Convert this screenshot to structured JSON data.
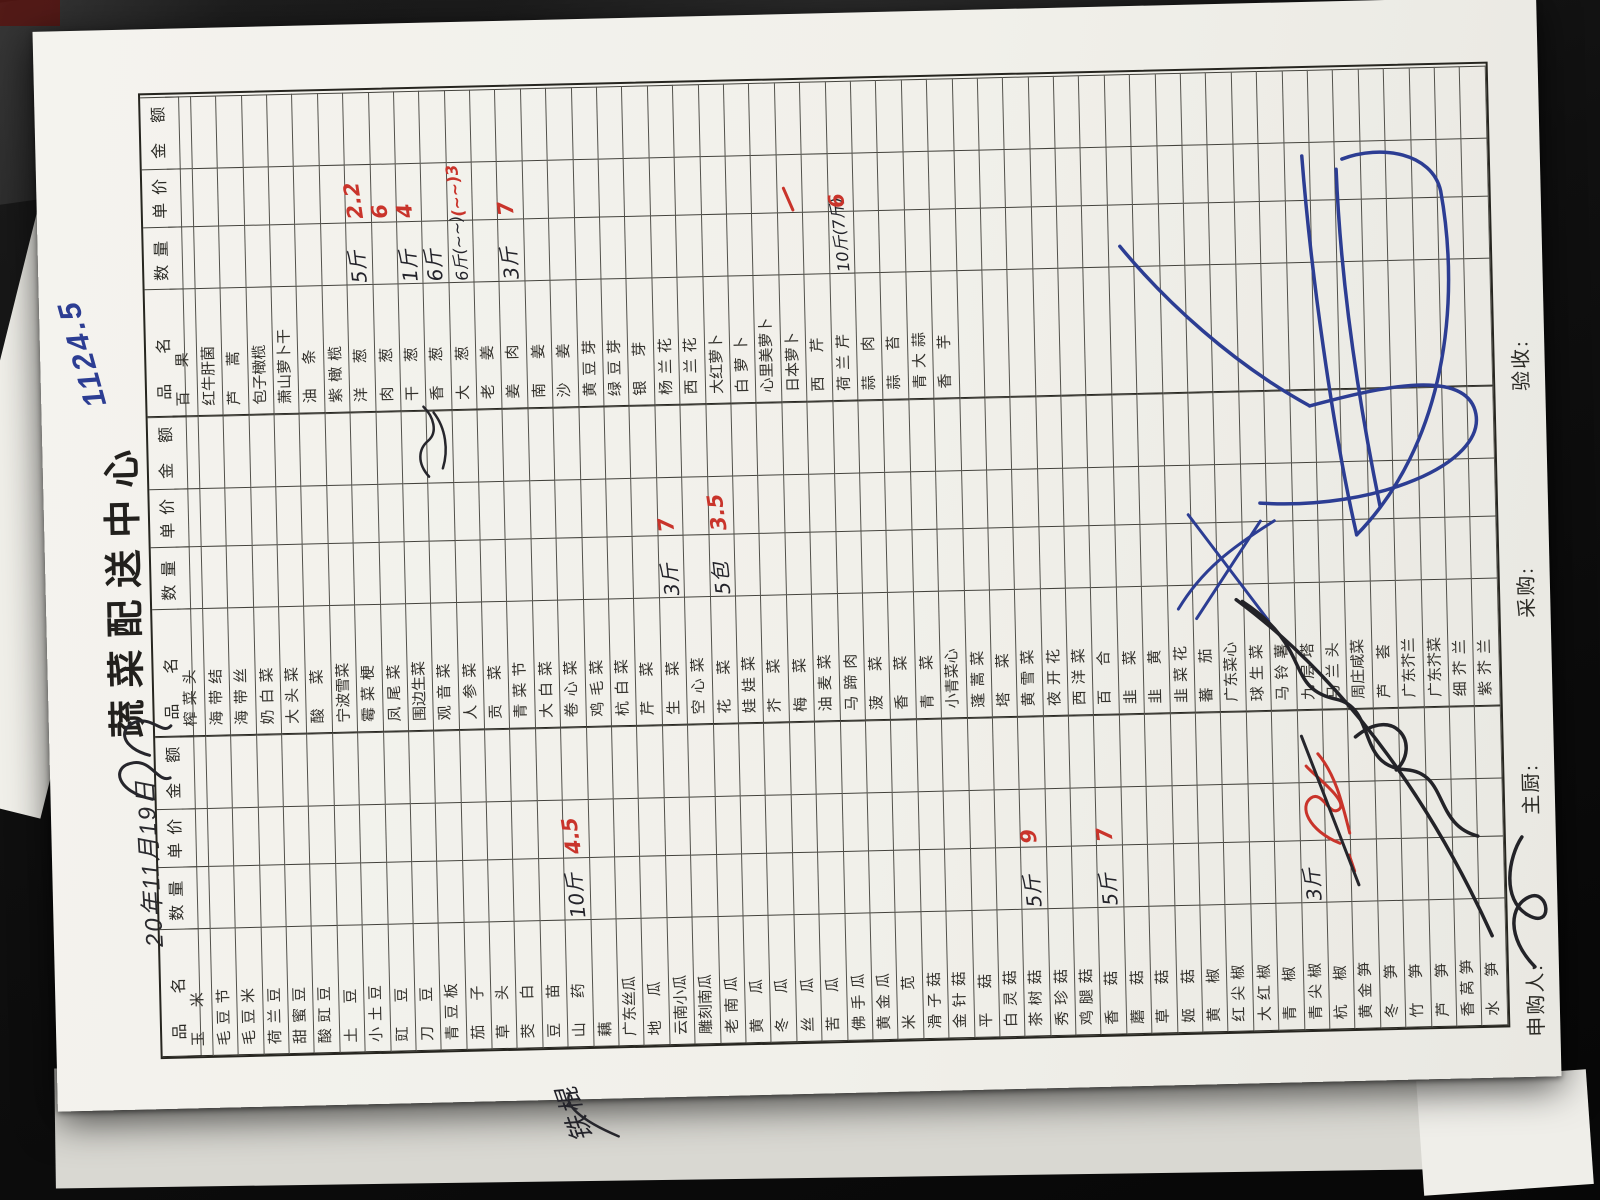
{
  "scene": {
    "background": "#0d0d0d",
    "paper_color": "#f2f1ec"
  },
  "ink": {
    "red": "#c9342b",
    "blue": "#2c3d93",
    "black": "#23232a"
  },
  "header": {
    "date_handwritten": "20年11月19日",
    "title": "蔬菜配送中心",
    "blue_total": "1124.5"
  },
  "table": {
    "column_headers": [
      "品名",
      "数量",
      "单价",
      "金额"
    ],
    "row_count": 52,
    "groups": [
      {
        "rows": [
          {
            "n": "玉米"
          },
          {
            "n": "毛豆节"
          },
          {
            "n": "毛豆米"
          },
          {
            "n": "荷兰豆"
          },
          {
            "n": "甜蜜豆"
          },
          {
            "n": "酸豇豆"
          },
          {
            "n": "土豆"
          },
          {
            "n": "小土豆"
          },
          {
            "n": "豇豆"
          },
          {
            "n": "刀豆"
          },
          {
            "n": "青豆板"
          },
          {
            "n": "茄子"
          },
          {
            "n": "草头"
          },
          {
            "n": "茭白"
          },
          {
            "n": "豆苗"
          },
          {
            "n": "山药",
            "q": "10斤",
            "p": "4.5",
            "note": "铁棍"
          },
          {
            "n": "藕"
          },
          {
            "n": "广东丝瓜"
          },
          {
            "n": "地瓜"
          },
          {
            "n": "云南小瓜"
          },
          {
            "n": "雕刻南瓜"
          },
          {
            "n": "老南瓜"
          },
          {
            "n": "黄瓜"
          },
          {
            "n": "冬瓜"
          },
          {
            "n": "丝瓜"
          },
          {
            "n": "苦瓜"
          },
          {
            "n": "佛手瓜"
          },
          {
            "n": "黄金瓜"
          },
          {
            "n": "米苋"
          },
          {
            "n": "滑子菇"
          },
          {
            "n": "金针菇"
          },
          {
            "n": "平菇"
          },
          {
            "n": "白灵菇"
          },
          {
            "n": "茶树菇",
            "q": "5斤",
            "p": "9"
          },
          {
            "n": "秀珍菇"
          },
          {
            "n": "鸡腿菇"
          },
          {
            "n": "香菇",
            "q": "5斤",
            "p": "7"
          },
          {
            "n": "蘑菇"
          },
          {
            "n": "草菇"
          },
          {
            "n": "姬菇"
          },
          {
            "n": "黄椒"
          },
          {
            "n": "红尖椒"
          },
          {
            "n": "大红椒"
          },
          {
            "n": "青椒"
          },
          {
            "n": "青尖椒",
            "q": "3斤"
          },
          {
            "n": "杭椒"
          },
          {
            "n": "黄金笋"
          },
          {
            "n": "冬笋"
          },
          {
            "n": "竹笋"
          },
          {
            "n": "芦笋"
          },
          {
            "n": "香莴笋"
          },
          {
            "n": "水笋"
          }
        ]
      },
      {
        "rows": [
          {
            "n": "榨菜头"
          },
          {
            "n": "海带结"
          },
          {
            "n": "海带丝"
          },
          {
            "n": "奶白菜"
          },
          {
            "n": "大头菜"
          },
          {
            "n": "酸菜"
          },
          {
            "n": "宁波雪菜"
          },
          {
            "n": "霉菜梗"
          },
          {
            "n": "凤尾菜"
          },
          {
            "n": "围边生菜"
          },
          {
            "n": "观音菜"
          },
          {
            "n": "人参菜"
          },
          {
            "n": "贡菜"
          },
          {
            "n": "青菜节"
          },
          {
            "n": "大白菜"
          },
          {
            "n": "卷心菜"
          },
          {
            "n": "鸡毛菜"
          },
          {
            "n": "杭白菜"
          },
          {
            "n": "芹菜"
          },
          {
            "n": "生菜",
            "q": "3斤",
            "p": "7"
          },
          {
            "n": "空心菜"
          },
          {
            "n": "花菜",
            "q": "5包",
            "p": "3.5"
          },
          {
            "n": "娃娃菜"
          },
          {
            "n": "芥菜"
          },
          {
            "n": "梅菜"
          },
          {
            "n": "油麦菜"
          },
          {
            "n": "马蹄肉"
          },
          {
            "n": "菠菜"
          },
          {
            "n": "香菜"
          },
          {
            "n": "青菜"
          },
          {
            "n": "小青菜心"
          },
          {
            "n": "蓬蒿菜"
          },
          {
            "n": "塔菜"
          },
          {
            "n": "黄雪菜"
          },
          {
            "n": "夜开花"
          },
          {
            "n": "西洋菜"
          },
          {
            "n": "百合"
          },
          {
            "n": "韭菜"
          },
          {
            "n": "韭黄"
          },
          {
            "n": "韭菜花"
          },
          {
            "n": "蕃茄"
          },
          {
            "n": "广东菜心"
          },
          {
            "n": "球生菜"
          },
          {
            "n": "马铃薯"
          },
          {
            "n": "九层塔"
          },
          {
            "n": "马兰头"
          },
          {
            "n": "周庄咸菜"
          },
          {
            "n": "芦荟"
          },
          {
            "n": "广东芥兰"
          },
          {
            "n": "广东芥菜"
          },
          {
            "n": "细芥兰"
          },
          {
            "n": "紫芥兰"
          }
        ]
      },
      {
        "rows": [
          {
            "n": "百果"
          },
          {
            "n": "红牛肝菌"
          },
          {
            "n": "芦蒿"
          },
          {
            "n": "包子橄榄"
          },
          {
            "n": "萧山萝卜干"
          },
          {
            "n": "油条"
          },
          {
            "n": "紫橄榄"
          },
          {
            "n": "洋葱",
            "q": "5斤",
            "p": "2.2"
          },
          {
            "n": "肉葱",
            "p": "6"
          },
          {
            "n": "干葱",
            "q": "1斤",
            "p": "4"
          },
          {
            "n": "香葱",
            "q": "6斤"
          },
          {
            "n": "大葱",
            "q": "6斤(~~)",
            "p": "(~~)3"
          },
          {
            "n": "老姜"
          },
          {
            "n": "姜肉",
            "q": "3斤",
            "p": "7"
          },
          {
            "n": "南姜"
          },
          {
            "n": "沙姜"
          },
          {
            "n": "黄豆芽"
          },
          {
            "n": "绿豆芽"
          },
          {
            "n": "银芽"
          },
          {
            "n": "杨兰花"
          },
          {
            "n": "西兰花"
          },
          {
            "n": "大红萝卜"
          },
          {
            "n": "白萝卜"
          },
          {
            "n": "心里美萝卜"
          },
          {
            "n": "日本萝卜"
          },
          {
            "n": "西芹"
          },
          {
            "n": "荷兰芹",
            "q": "10斤(7斤)",
            "p": "6"
          },
          {
            "n": "蒜肉"
          },
          {
            "n": "蒜苔"
          },
          {
            "n": "青大蒜"
          },
          {
            "n": "香芋"
          }
        ]
      }
    ]
  },
  "annotations": {
    "yam_margin_note": "铁棍",
    "scribbles": [
      "black scribble beside date",
      "black note under 干葱",
      "red crossed-out price at 青尖椒",
      "blue cross marks over group-2 price cells",
      "large black signature scribble over lower rows",
      "large blue inspector signature scribble"
    ]
  },
  "footer": {
    "requester_label": "申购人:",
    "chef_label": "主厨:",
    "purchaser_label": "采购:",
    "inspector_label": "验收:"
  }
}
